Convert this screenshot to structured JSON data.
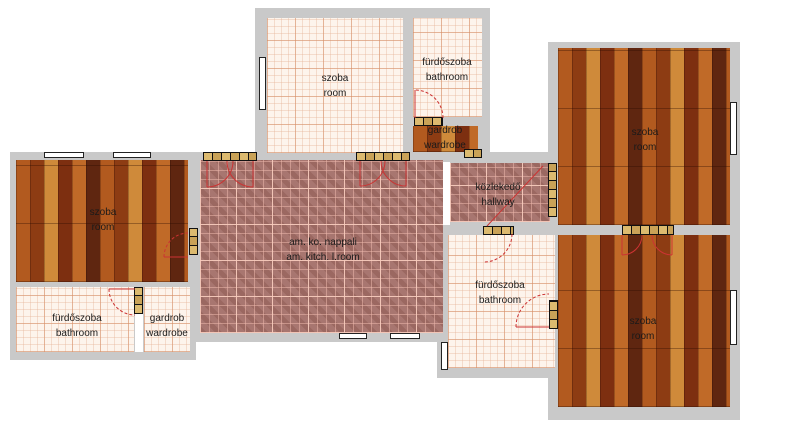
{
  "rooms": [
    {
      "id": "room-top-center",
      "label_hu": "szoba",
      "label_en": "room",
      "floor": "tile-light"
    },
    {
      "id": "bathroom-top",
      "label_hu": "fürdőszoba",
      "label_en": "bathroom",
      "floor": "tile-light"
    },
    {
      "id": "wardrobe-top",
      "label_hu": "gardrob",
      "label_en": "wardrobe",
      "floor": "wood"
    },
    {
      "id": "room-right-top",
      "label_hu": "szoba",
      "label_en": "room",
      "floor": "wood"
    },
    {
      "id": "room-left",
      "label_hu": "szoba",
      "label_en": "room",
      "floor": "wood"
    },
    {
      "id": "living-kitchen",
      "label_hu": "am. ko. nappali",
      "label_en": "am. kitch. l.room",
      "floor": "tile-red"
    },
    {
      "id": "hallway",
      "label_hu": "közlekedő",
      "label_en": "hallway",
      "floor": "tile-red"
    },
    {
      "id": "bathroom-left",
      "label_hu": "fürdőszoba",
      "label_en": "bathroom",
      "floor": "tile-light"
    },
    {
      "id": "wardrobe-left",
      "label_hu": "gardrob",
      "label_en": "wardrobe",
      "floor": "tile-light"
    },
    {
      "id": "bathroom-bottom",
      "label_hu": "fürdőszoba",
      "label_en": "bathroom",
      "floor": "tile-light"
    },
    {
      "id": "room-right-bottom",
      "label_hu": "szoba",
      "label_en": "room",
      "floor": "wood"
    }
  ],
  "colors": {
    "wall": "#c9c9c9",
    "wood_floor": "#a9521f",
    "tile_light": "#fdf4ec",
    "tile_red": "#a87670",
    "grout": "#e9b7aa",
    "door_unit": "#d7b56a",
    "door_swing": "#cc3333",
    "window": "#ffffff",
    "text": "#1a1a1a"
  }
}
